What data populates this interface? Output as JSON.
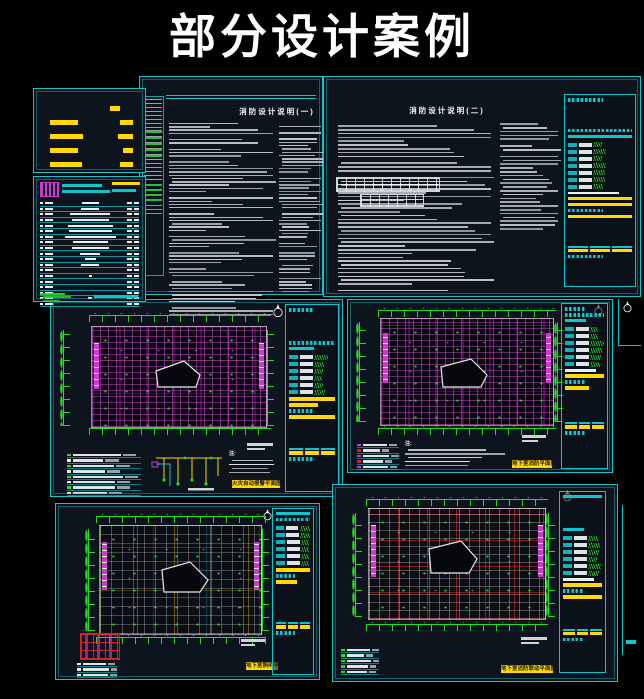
{
  "page": {
    "title": "部分设计案例"
  },
  "palette": {
    "background": "#000000",
    "sheet_bg": "#0d141d",
    "cyan_border": "#0fc4cc",
    "yellow": "#ffd900",
    "green": "#22dd22",
    "magenta": "#cc3ccc",
    "red": "#d42222",
    "white": "#eceff2",
    "gray": "#9aa0a6"
  },
  "sheets": {
    "legend_small": {
      "name": "图例",
      "dashes": [
        [
          14
        ],
        [
          34,
          16
        ],
        [
          40,
          18
        ],
        [
          34,
          12
        ],
        [
          38,
          16
        ]
      ]
    },
    "drawing_list": {
      "name": "图纸目录"
    },
    "spec1": {
      "title": "消防设计说明(一)"
    },
    "spec2": {
      "title": "消防设计说明(二)"
    },
    "plan1": {
      "caption": "火灾自动报警平面图",
      "notes_header": "注:"
    },
    "plan2": {
      "caption": "地下室消防平面图",
      "notes_header": "注:"
    },
    "plan3": {
      "caption": "地下室照明平面图"
    },
    "plan4": {
      "caption": "地下室消防联动平面图",
      "notes_header": "注:"
    }
  }
}
